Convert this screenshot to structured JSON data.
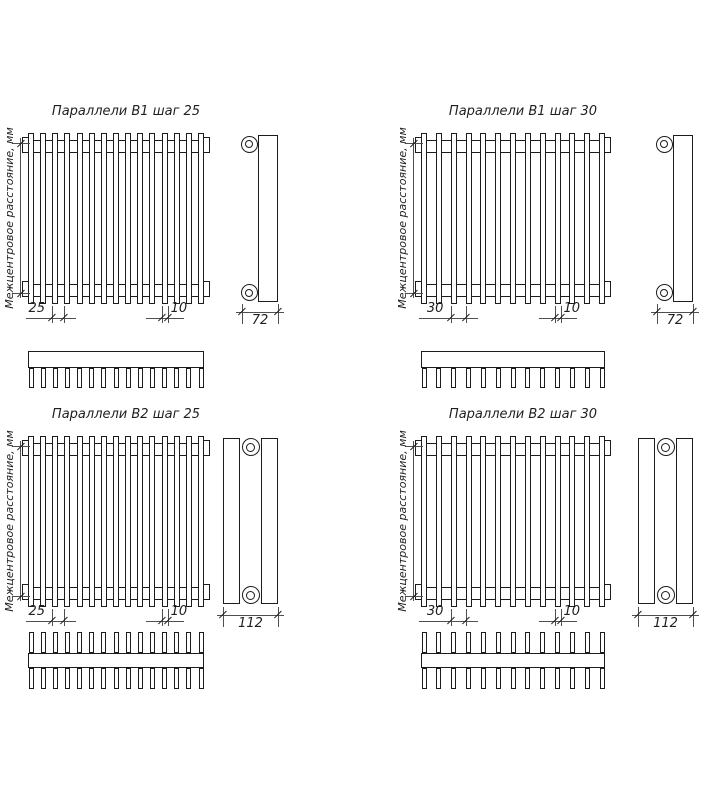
{
  "drawing": {
    "background": "#ffffff",
    "line_color": "#1c1c1c",
    "thin_line_color": "#4f4f4f",
    "text_color": "#1f1f1f"
  },
  "diagrams": [
    {
      "id": "v1-step-25",
      "title": "Параллели В1 шаг 25",
      "axis_label": "Межцентровое расстояние, мм",
      "step_label": "25",
      "tube_width_label": "10",
      "depth_label": "72",
      "tube_count": 15,
      "tube_rows": 1,
      "position": {
        "col": 0,
        "row": 0
      }
    },
    {
      "id": "v1-step-30",
      "title": "Параллели В1 шаг 30",
      "axis_label": "Межцентровое расстояние, мм",
      "step_label": "30",
      "tube_width_label": "10",
      "depth_label": "72",
      "tube_count": 13,
      "tube_rows": 1,
      "position": {
        "col": 1,
        "row": 0
      }
    },
    {
      "id": "v2-step-25",
      "title": "Параллели В2 шаг 25",
      "axis_label": "Межцентровое расстояние, мм",
      "step_label": "25",
      "tube_width_label": "10",
      "depth_label": "112",
      "tube_count": 15,
      "tube_rows": 2,
      "position": {
        "col": 0,
        "row": 1
      }
    },
    {
      "id": "v2-step-30",
      "title": "Параллели В2 шаг 30",
      "axis_label": "Межцентровое расстояние, мм",
      "step_label": "30",
      "tube_width_label": "10",
      "depth_label": "112",
      "tube_count": 13,
      "tube_rows": 2,
      "position": {
        "col": 1,
        "row": 1
      }
    }
  ]
}
